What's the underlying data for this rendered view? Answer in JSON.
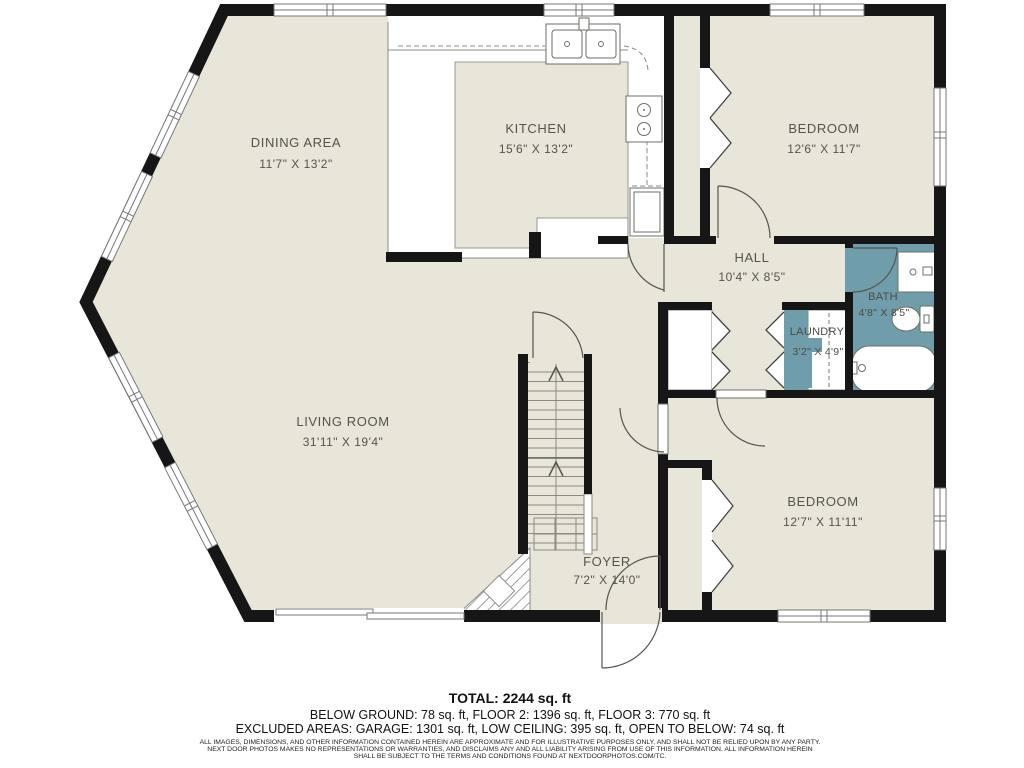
{
  "rooms": {
    "dining": {
      "name": "DINING AREA",
      "dims": "11'7\" X 13'2\""
    },
    "kitchen": {
      "name": "KITCHEN",
      "dims": "15'6\" X 13'2\""
    },
    "bedroom1": {
      "name": "BEDROOM",
      "dims": "12'6\" X 11'7\""
    },
    "hall": {
      "name": "HALL",
      "dims": "10'4\" X 8'5\""
    },
    "bath": {
      "name": "BATH",
      "dims": "4'8\" X 8'5\""
    },
    "laundry": {
      "name": "LAUNDRY",
      "dims": "3'2\" X 4'9\""
    },
    "living": {
      "name": "LIVING ROOM",
      "dims": "31'11\" X 19'4\""
    },
    "bedroom2": {
      "name": "BEDROOM",
      "dims": "12'7\" X 11'11\""
    },
    "foyer": {
      "name": "FOYER",
      "dims": "7'2\" X 14'0\""
    }
  },
  "summary": {
    "total": "TOTAL: 2244 sq. ft",
    "floors": "BELOW GROUND: 78 sq. ft, FLOOR 2: 1396 sq. ft, FLOOR 3: 770 sq. ft",
    "excluded": "EXCLUDED AREAS: GARAGE: 1301 sq. ft, LOW CEILING: 395 sq. ft, OPEN TO BELOW: 74 sq. ft"
  },
  "disclaimer": {
    "l1": "ALL IMAGES, DIMENSIONS, AND OTHER INFORMATION CONTAINED HEREIN ARE APPROXIMATE AND FOR ILLUSTRATIVE PURPOSES ONLY, AND SHALL NOT BE RELIED UPON BY ANY PARTY.",
    "l2": "NEXT DOOR PHOTOS MAKES NO REPRESENTATIONS OR WARRANTIES, AND DISCLAIMS ANY AND ALL LIABILITY ARISING FROM USE OF THIS INFORMATION. ALL INFORMATION HEREIN",
    "l3": "SHALL BE SUBJECT TO THE TERMS AND CONDITIONS FOUND AT NEXTDOORPHOTOS.COM/TC."
  },
  "colors": {
    "floor": "#e8e6d8",
    "wet_area": "#6f9dab",
    "wall": "#161616"
  }
}
